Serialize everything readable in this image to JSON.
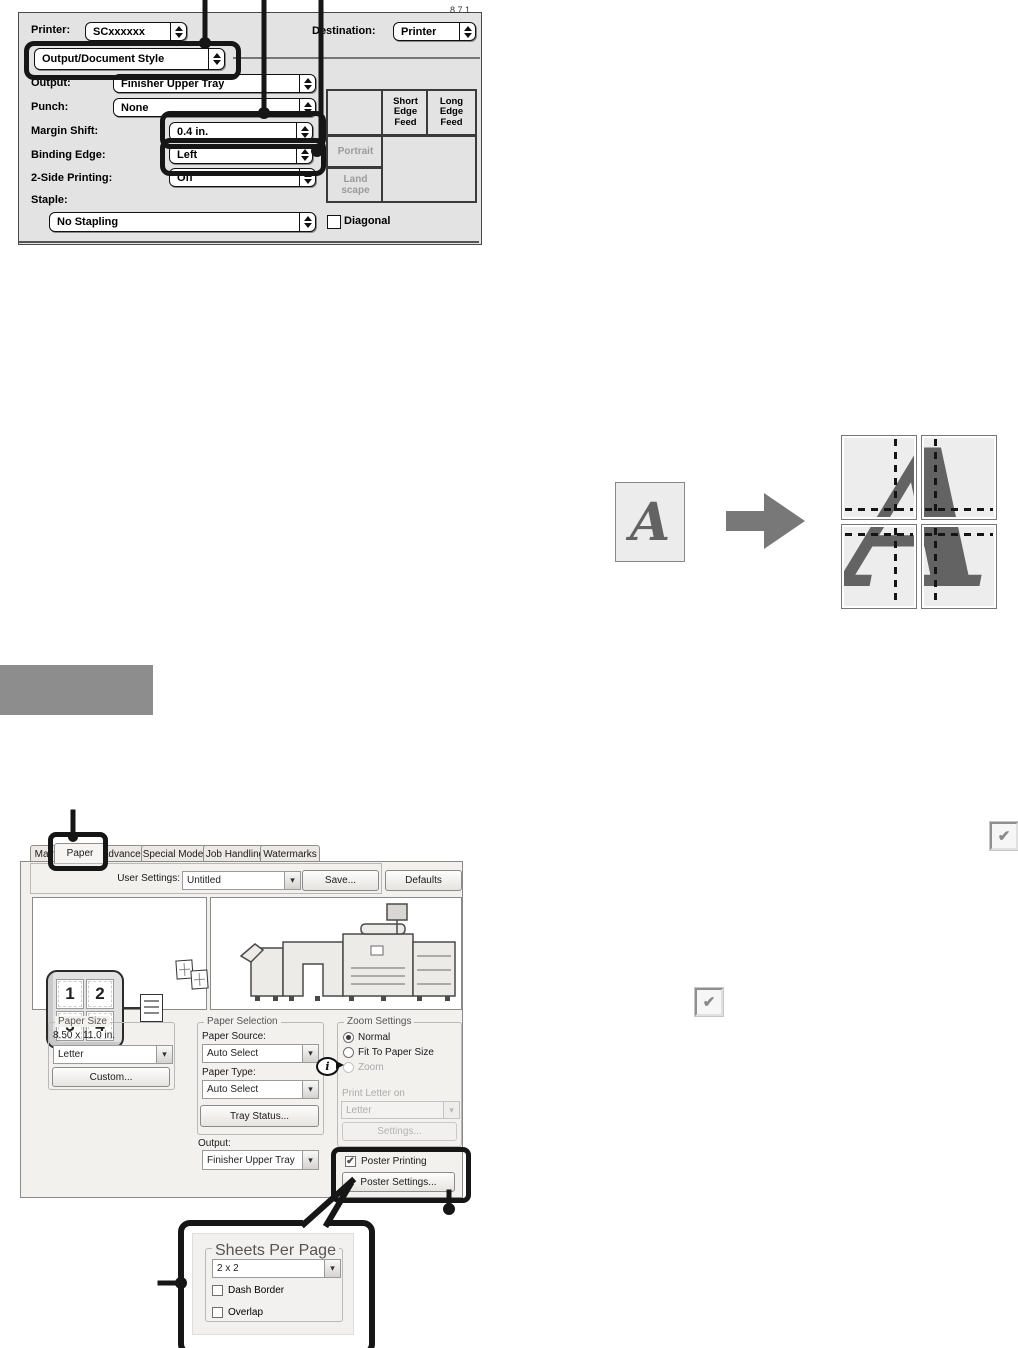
{
  "meta": {
    "version": "8.7.1"
  },
  "icons": {
    "chevron": "▾",
    "check": "✔",
    "info": "i"
  },
  "mac_dialog": {
    "printer_label": "Printer:",
    "printer_value": "SCxxxxxx",
    "destination_label": "Destination:",
    "destination_value": "Printer",
    "section_value": "Output/Document Style",
    "rows": [
      {
        "label": "Output:",
        "value": "Finisher Upper Tray"
      },
      {
        "label": "Punch:",
        "value": "None"
      },
      {
        "label": "Margin Shift:",
        "value": "0.4 in."
      },
      {
        "label": "Binding Edge:",
        "value": "Left"
      },
      {
        "label": "2-Side Printing:",
        "value": "Off"
      }
    ],
    "staple_label": "Staple:",
    "staple_value": "No Stapling",
    "diagonal_label": "Diagonal",
    "feed_table": {
      "col_headers": [
        "Short Edge Feed",
        "Long Edge Feed"
      ],
      "row_headers": [
        "Portrait",
        "Land scape"
      ]
    }
  },
  "poster_illustration": {
    "letter": "A"
  },
  "win_dialog": {
    "tabs": [
      "Main",
      "Paper",
      "Advanced",
      "Special Modes",
      "Job Handling",
      "Watermarks"
    ],
    "user_settings_label": "User Settings:",
    "user_settings_value": "Untitled",
    "save_button": "Save...",
    "defaults_button": "Defaults",
    "preview_numbers": [
      "1",
      "2",
      "3",
      "4"
    ],
    "paper_size": {
      "title": "Paper Size",
      "dimensions": "8.50 x 11.0 in.",
      "value": "Letter",
      "custom_button": "Custom..."
    },
    "paper_selection": {
      "title": "Paper Selection",
      "source_label": "Paper Source:",
      "source_value": "Auto Select",
      "type_label": "Paper Type:",
      "type_value": "Auto Select",
      "tray_button": "Tray Status..."
    },
    "output_label": "Output:",
    "output_value": "Finisher Upper Tray",
    "zoom_settings": {
      "title": "Zoom Settings",
      "normal_label": "Normal",
      "fit_label": "Fit To Paper Size",
      "zoom_label": "Zoom",
      "print_on_label": "Print Letter on",
      "print_on_value": "Letter",
      "settings_button": "Settings..."
    },
    "poster_printing_label": "Poster Printing",
    "poster_settings_button": "Poster Settings..."
  },
  "poster_popup": {
    "title": "Sheets Per Page",
    "value": "2 x 2",
    "dash_border_label": "Dash Border",
    "overlap_label": "Overlap"
  },
  "colors": {
    "callout": "#161616",
    "section_block": "#8d8d8d"
  }
}
